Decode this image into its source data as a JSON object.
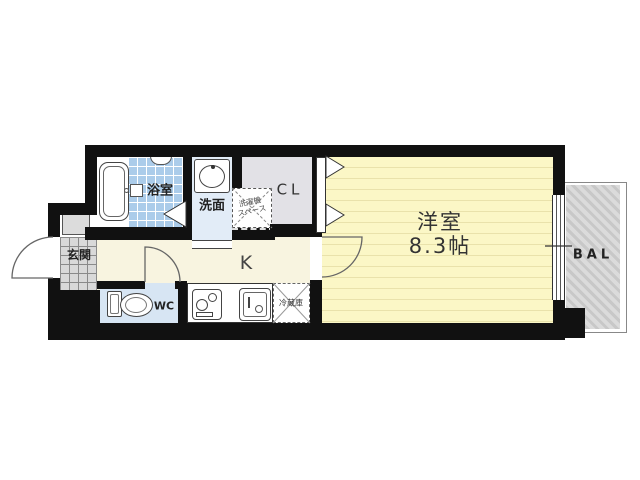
{
  "plan": {
    "bathroom_label": "浴室",
    "washroom_label": "洗面",
    "laundry_line1": "洗濯機",
    "laundry_line2": "スペース",
    "closet_label": "CL",
    "entrance_label": "玄関",
    "kitchen_label": "K",
    "toilet_label": "WC",
    "fridge_label": "冷蔵庫",
    "main_room_label": "洋室",
    "main_room_size": "8.3帖",
    "balcony_label": "BAL"
  },
  "colors": {
    "wall": "#111111",
    "main_room_fill": "#fbf7c6",
    "main_room_stripe": "#e9e2ab",
    "kitchen_fill": "#f8f4e0",
    "bath_tile": "#abccea",
    "washroom_fill": "#e2ecf7",
    "toilet_fill": "#d7e5f3",
    "closet_fill": "#e2e1e6",
    "entrance_tile": "#d9d9d9",
    "balcony_hatch": "#c8c8c8"
  }
}
